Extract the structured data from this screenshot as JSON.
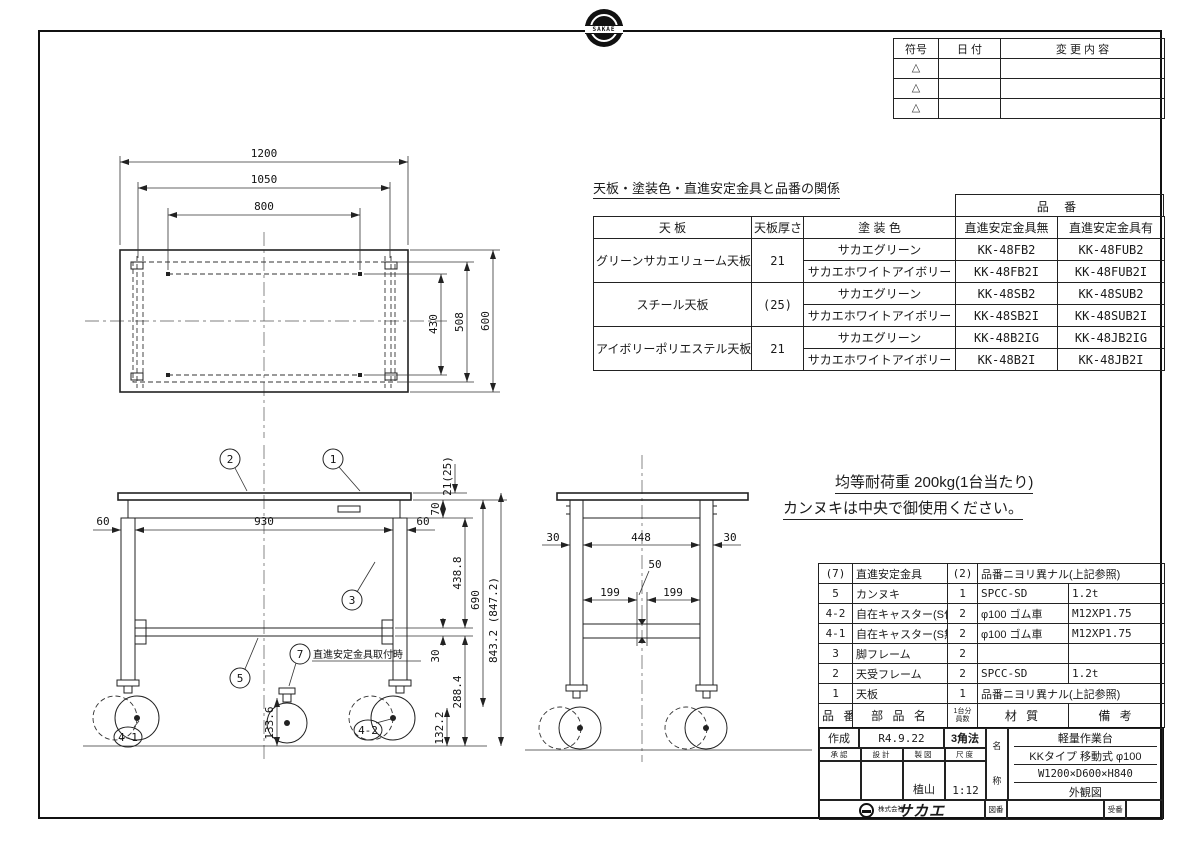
{
  "page": {
    "paper_color": "#ffffff",
    "ink_color": "#1a1a1a"
  },
  "stamp": {
    "text": "SAKAE"
  },
  "revision_table": {
    "headers": {
      "symbol": "符号",
      "date": "日 付",
      "change": "変 更 内 容"
    },
    "rows": [
      {
        "symbol": "△"
      },
      {
        "symbol": "△"
      },
      {
        "symbol": "△"
      }
    ]
  },
  "product_table": {
    "title": "天板・塗装色・直進安定金具と品番の関係",
    "part_no_header": "品 番",
    "headers": {
      "top": "天 板",
      "thickness": "天板厚さ",
      "color": "塗 装 色",
      "without": "直進安定金具無",
      "with": "直進安定金具有"
    },
    "groups": [
      {
        "top": "グリーンサカエリューム天板",
        "thickness": "21",
        "variants": [
          {
            "color": "サカエグリーン",
            "without": "KK-48FB2",
            "with": "KK-48FUB2"
          },
          {
            "color": "サカエホワイトアイボリー",
            "without": "KK-48FB2I",
            "with": "KK-48FUB2I"
          }
        ]
      },
      {
        "top": "スチール天板",
        "thickness": "(25)",
        "variants": [
          {
            "color": "サカエグリーン",
            "without": "KK-48SB2",
            "with": "KK-48SUB2"
          },
          {
            "color": "サカエホワイトアイボリー",
            "without": "KK-48SB2I",
            "with": "KK-48SUB2I"
          }
        ]
      },
      {
        "top": "アイボリーポリエステル天板",
        "thickness": "21",
        "variants": [
          {
            "color": "サカエグリーン",
            "without": "KK-48B2IG",
            "with": "KK-48JB2IG"
          },
          {
            "color": "サカエホワイトアイボリー",
            "without": "KK-48B2I",
            "with": "KK-48JB2I"
          }
        ]
      }
    ]
  },
  "notes": {
    "line1": "均等耐荷重  200kg(1台当たり)",
    "line2": "カンヌキは中央で御使用ください。"
  },
  "parts_table": {
    "headers": {
      "no": "品 番",
      "name": "部 品 名",
      "qty_line1": "1台分",
      "qty_line2": "員数",
      "material": "材 質",
      "remarks": "備 考"
    },
    "rows": [
      {
        "no": "(7)",
        "name": "直進安定金具",
        "qty": "(2)",
        "material": "品番ニヨリ異ナル(上記参照)",
        "remarks": ""
      },
      {
        "no": "5",
        "name": "カンヌキ",
        "qty": "1",
        "material": "SPCC-SD",
        "remarks": "1.2t"
      },
      {
        "no": "4-2",
        "name": "自在キャスター(S付)",
        "qty": "2",
        "material": "φ100 ゴム車",
        "remarks": "M12XP1.75"
      },
      {
        "no": "4-1",
        "name": "自在キャスター(S無)",
        "qty": "2",
        "material": "φ100 ゴム車",
        "remarks": "M12XP1.75"
      },
      {
        "no": "3",
        "name": "脚フレーム",
        "qty": "2",
        "material": "",
        "remarks": ""
      },
      {
        "no": "2",
        "name": "天受フレーム",
        "qty": "2",
        "material": "SPCC-SD",
        "remarks": "1.2t"
      },
      {
        "no": "1",
        "name": "天板",
        "qty": "1",
        "material": "品番ニヨリ異ナル(上記参照)",
        "remarks": ""
      }
    ]
  },
  "title_block": {
    "created_label": "作成",
    "created_date": "R4.9.22",
    "projection": "3角法",
    "approval_label": "承認",
    "design_label": "設計",
    "drafting_label": "製図",
    "scale_label": "尺度",
    "drafter": "植山",
    "scale": "1:12",
    "name_label_top": "名",
    "name_label_bottom": "称",
    "name_line1": "軽量作業台",
    "name_line2": "KKタイプ 移動式 φ100",
    "name_line3": "W1200×D600×H840",
    "name_line4": "外観図",
    "company_prefix": "株式会社",
    "company_name": "サカエ",
    "drawing_no_label": "図番",
    "page_no_label": "受番"
  },
  "drawing": {
    "top_view": {
      "d1200": "1200",
      "d1050": "1050",
      "d800": "800",
      "d600": "600",
      "d508": "508",
      "d430": "430"
    },
    "front_view": {
      "d60_left": "60",
      "d930": "930",
      "d60_right": "60",
      "d21": "21(25)",
      "d70": "70",
      "d438": "438.8",
      "d690": "690",
      "d843": "843.2 (847.2)",
      "d30": "30",
      "d288": "288.4",
      "d133": "133.6",
      "d132": "132.2",
      "balloon_1": "1",
      "balloon_2": "2",
      "balloon_3": "3",
      "balloon_5": "5",
      "balloon_7": "7",
      "balloon_4_1": "4-1",
      "balloon_4_2": "4-2",
      "balloon_7_note": "直進安定金具取付時"
    },
    "side_view": {
      "d30_left": "30",
      "d448": "448",
      "d30_right": "30",
      "d50": "50",
      "d199_left": "199",
      "d199_right": "199"
    }
  }
}
